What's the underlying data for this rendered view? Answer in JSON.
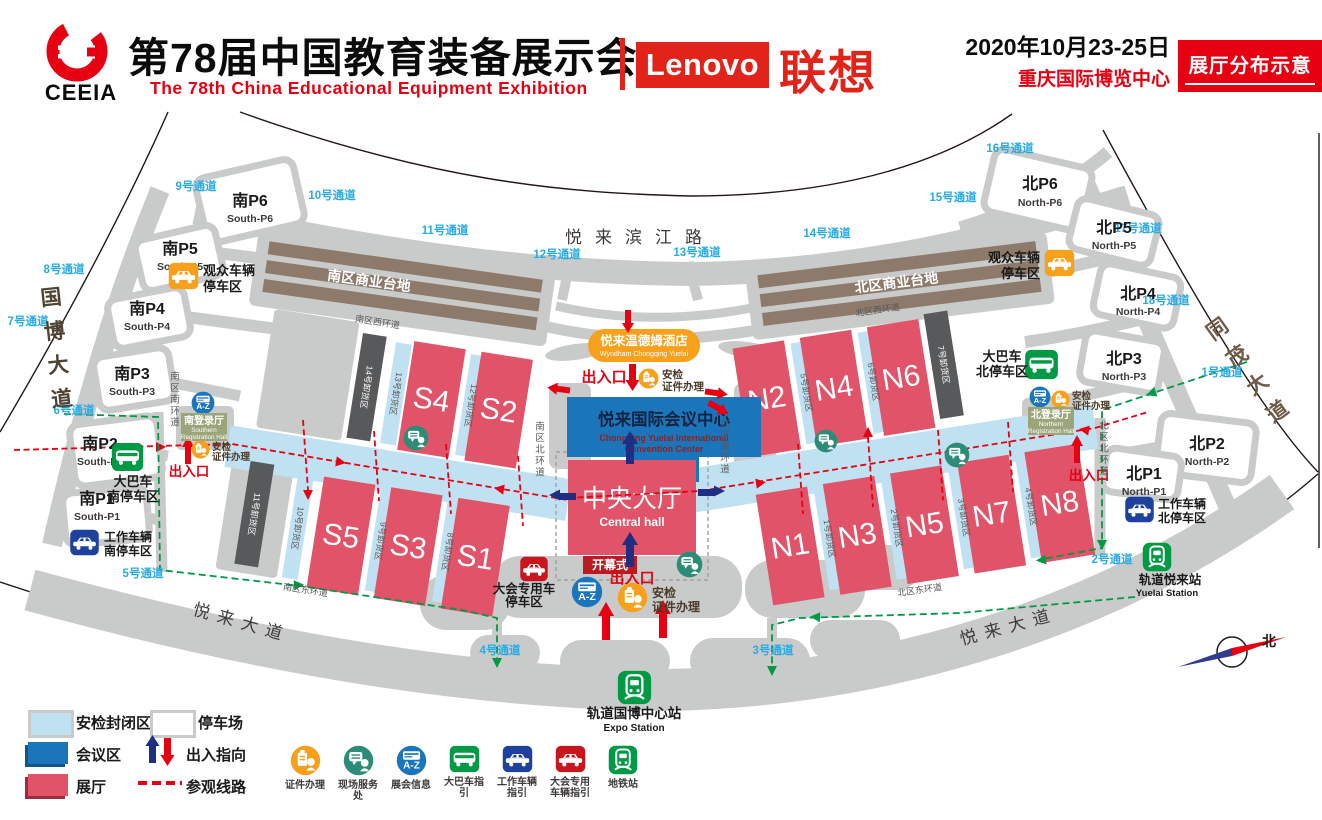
{
  "header": {
    "logo": "CEEIA",
    "title_cn": "第78届中国教育装备展示会",
    "title_en": "The 78th China Educational Equipment Exhibition",
    "lenovo_en": "Lenovo",
    "lenovo_cn": "联想",
    "date": "2020年10月23-25日",
    "venue": "重庆国际博览中心",
    "badge": "展厅分布示意"
  },
  "map": {
    "channels": [
      "9号通道",
      "10号通道",
      "11号通道",
      "12号通道",
      "13号通道",
      "14号通道",
      "15号通道",
      "16号通道",
      "17号通道",
      "18号通道",
      "1号通道",
      "2号通道",
      "3号通道",
      "4号通道",
      "5号通道",
      "6号通道",
      "7号通道",
      "8号通道"
    ],
    "parking_south": [
      {
        "cn": "南P6",
        "en": "South-P6"
      },
      {
        "cn": "南P5",
        "en": "South-P5"
      },
      {
        "cn": "南P4",
        "en": "South-P4"
      },
      {
        "cn": "南P3",
        "en": "South-P3"
      },
      {
        "cn": "南P2",
        "en": "South-P2"
      },
      {
        "cn": "南P1",
        "en": "South-P1"
      }
    ],
    "parking_north": [
      {
        "cn": "北P6",
        "en": "North-P6"
      },
      {
        "cn": "北P5",
        "en": "North-P5"
      },
      {
        "cn": "北P4",
        "en": "North-P4"
      },
      {
        "cn": "北P3",
        "en": "North-P3"
      },
      {
        "cn": "北P2",
        "en": "North-P2"
      },
      {
        "cn": "北P1",
        "en": "North-P1"
      }
    ],
    "halls": {
      "south_upper": [
        "S4",
        "S2"
      ],
      "south_lower": [
        "S5",
        "S3",
        "S1"
      ],
      "north_upper": [
        "N2",
        "N4",
        "N6"
      ],
      "north_lower": [
        "N1",
        "N3",
        "N5",
        "N7",
        "N8"
      ]
    },
    "unloading": {
      "s13": "13号卸货区",
      "s12": "12号卸货区",
      "s14": "14号卸货区",
      "s10": "10号卸货区",
      "s9": "9号卸货区",
      "s8": "8号卸货区",
      "s11": "11号卸货区",
      "n5": "5号卸货区",
      "n6": "6号卸货区",
      "n7": "7号卸货区",
      "n1": "1号卸货区",
      "n2": "2号卸货区",
      "n3": "3号卸货区",
      "n4": "4号卸货区"
    },
    "roads": {
      "binjiang": "悦来滨江路",
      "guobo": "国博大道",
      "tongmao": "同茂大道",
      "yuelai": "悦来大道",
      "s_commercial": "南区商业台地",
      "n_commercial": "北区商业台地",
      "s_west": "南区西环道",
      "n_west": "北区西环道",
      "s_south": "南区南环道",
      "n_south": "北区南环道",
      "s_north": "南区北环道",
      "n_north": "北区北环道",
      "s_east": "南区东环道",
      "n_east": "北区东环道"
    },
    "hotel": {
      "cn": "悦来温德姆酒店",
      "en": "Wyndham Chongqing Yuelai"
    },
    "convention": {
      "cn": "悦来国际会议中心",
      "en1": "Chongqing Yuelai International",
      "en2": "Convention Center"
    },
    "central_hall": {
      "cn": "中央大厅",
      "en": "Central hall"
    },
    "opening": "开幕式",
    "entrance": "出入口",
    "security": {
      "l1": "安检",
      "l2": "证件办理"
    },
    "registration": {
      "south": {
        "cn": "南登录厅",
        "en1": "Southern",
        "en2": "Registration Hall"
      },
      "north": {
        "cn": "北登录厅",
        "en1": "Northern",
        "en2": "Registration Hall"
      }
    },
    "stations": {
      "expo": {
        "cn": "轨道国博中心站",
        "en": "Expo Station"
      },
      "yuelai": {
        "cn": "轨道悦来站",
        "en": "Yuelai Station"
      }
    },
    "vehicles": {
      "visitor": {
        "l1": "观众车辆",
        "l2": "停车区"
      },
      "bus_south": {
        "l1": "大巴车",
        "l2": "南停车区"
      },
      "bus_north": {
        "l1": "大巴车",
        "l2": "北停车区"
      },
      "work_south": {
        "l1": "工作车辆",
        "l2": "南停车区"
      },
      "work_north": {
        "l1": "工作车辆",
        "l2": "北停车区"
      },
      "dedicated": {
        "l1": "大会专用车",
        "l2": "停车区"
      }
    },
    "az": "A-Z",
    "compass_north": "北"
  },
  "legend": {
    "swatches": [
      "安检封闭区",
      "停车场",
      "会议区",
      "出入指向",
      "展厅",
      "参观线路"
    ],
    "icons": [
      {
        "label": "证件办理"
      },
      {
        "label": "现场服务处"
      },
      {
        "label": "展会信息"
      },
      {
        "label": "大巴车指引"
      },
      {
        "label": "工作车辆指引"
      },
      {
        "label": "大会专用",
        "label2": "车辆指引"
      },
      {
        "label": "地铁站"
      }
    ]
  },
  "colors": {
    "accent_red": "#e60012",
    "hall_red": "#e05368",
    "secure_blue": "#bfe1f2",
    "conference_blue": "#1b75bb",
    "channel_blue": "#29abe2",
    "route_green": "#009944",
    "orange": "#f7a01b",
    "teal": "#2d8c77",
    "navy": "#1f419e",
    "road_gray": "#c9caca",
    "dark_slab": "#58595b",
    "commercial_brown": "#8d7a6b"
  }
}
